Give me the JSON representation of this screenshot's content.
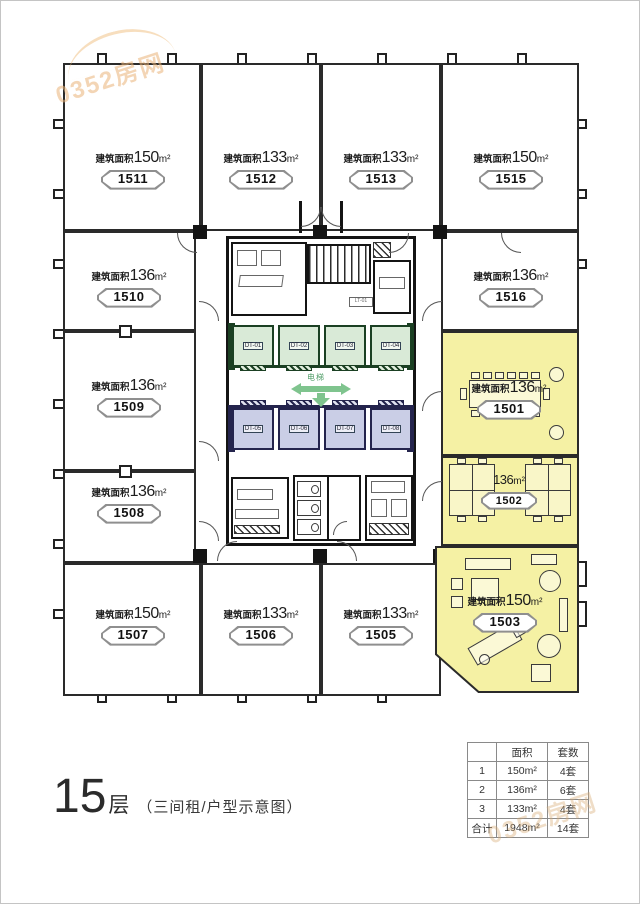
{
  "watermarks": {
    "top_left": "0352房网",
    "bottom_right": "0352房网"
  },
  "title": {
    "floor": "15",
    "floor_unit": "层",
    "subtitle": "（三间租/户型示意图）"
  },
  "labels": {
    "area_prefix": "建筑面积",
    "area_unit": "m²",
    "elevator_hall": "电梯",
    "stair": "LT-01"
  },
  "units": {
    "u1511": {
      "id": "1511",
      "value": "150"
    },
    "u1512": {
      "id": "1512",
      "value": "133"
    },
    "u1513": {
      "id": "1513",
      "value": "133"
    },
    "u1515": {
      "id": "1515",
      "value": "150"
    },
    "u1510": {
      "id": "1510",
      "value": "136"
    },
    "u1516": {
      "id": "1516",
      "value": "136"
    },
    "u1509": {
      "id": "1509",
      "value": "136"
    },
    "u1501": {
      "id": "1501",
      "value": "136"
    },
    "u1508": {
      "id": "1508",
      "value": "136"
    },
    "u1502": {
      "id": "1502",
      "value": "136"
    },
    "u1507": {
      "id": "1507",
      "value": "150"
    },
    "u1506": {
      "id": "1506",
      "value": "133"
    },
    "u1505": {
      "id": "1505",
      "value": "133"
    },
    "u1503": {
      "id": "1503",
      "value": "150"
    }
  },
  "elevators": {
    "green": [
      "DT-01",
      "DT-02",
      "DT-03",
      "DT-04"
    ],
    "blue": [
      "DT-05",
      "DT-06",
      "DT-07",
      "DT-08"
    ]
  },
  "summary_table": {
    "headers": [
      "",
      "面积",
      "套数"
    ],
    "rows": [
      [
        "1",
        "150m²",
        "4套"
      ],
      [
        "2",
        "136m²",
        "6套"
      ],
      [
        "3",
        "133m²",
        "4套"
      ],
      [
        "合计",
        "1948m²",
        "14套"
      ]
    ]
  },
  "colors": {
    "highlight_yellow": "#f5f1a4",
    "elevator_green_fill": "#d9ead7",
    "elevator_blue_fill": "#cacee6",
    "arrow_green": "#7fc48e",
    "watermark_orange": "#e9b278"
  }
}
